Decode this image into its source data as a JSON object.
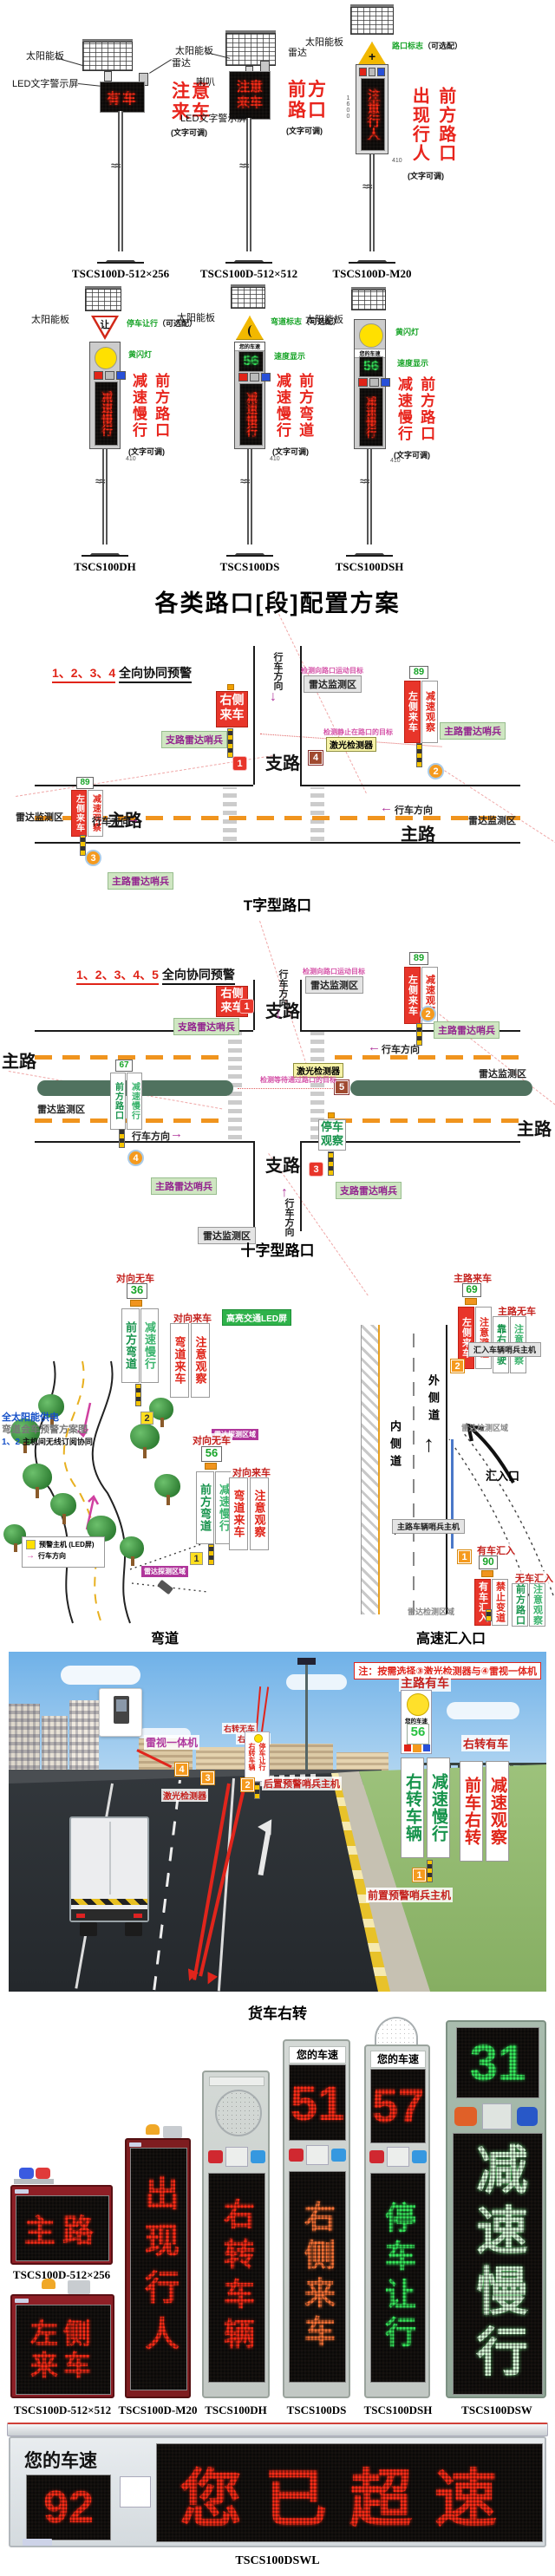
{
  "heading": "各类路口[段]配置方案",
  "colors": {
    "accent_red": "#e8241c",
    "led_red": "#ff2d18",
    "led_green": "#38e85c",
    "marker_orange": "#f59a1e",
    "median_green": "#50725f",
    "dash_orange": "#f0941e"
  },
  "row1": {
    "u1": {
      "model": "TSCS100D-512×256",
      "solar": "太阳能板",
      "radar": "雷达",
      "screen": "LED文字警示屏",
      "led": "有车",
      "ann": "注意来车",
      "note": "(文字可调)"
    },
    "u2": {
      "model": "TSCS100D-512×512",
      "solar": "太阳能板",
      "radar": "雷达",
      "horn": "喇叭",
      "screen": "LED文字警示屏",
      "led": "注意来车",
      "ann": "前方路口",
      "note": "(文字可调)"
    },
    "u3": {
      "model": "TSCS100D-M20",
      "solar": "太阳能板",
      "opt": "路口标志",
      "opt_note": "（可选配）",
      "led": "注意行人",
      "ann_left": "出现行人",
      "ann_right": "前方路口",
      "note": "(文字可调)",
      "dim_h": "1600",
      "dim_w": "410"
    }
  },
  "row2": {
    "u1": {
      "model": "TSCS100DH",
      "solar": "太阳能板",
      "opt": "停车让行",
      "opt_note": "（可选配）",
      "yield_char": "让",
      "light": "黄闪灯",
      "led": "减速慢行",
      "ann_left": "减速慢行",
      "ann_right": "前方路口",
      "note": "(文字可调)",
      "dim_w": "410"
    },
    "u2": {
      "model": "TSCS100DS",
      "solar": "太阳能板",
      "opt": "弯道标志",
      "opt_note": "（可选配）",
      "speed_title": "您的车速",
      "speed": "56",
      "speed_label": "速度显示",
      "led": "减速慢行",
      "ann_left": "减速慢行",
      "ann_right": "前方弯道",
      "note": "(文字可调)",
      "dim_w": "410"
    },
    "u3": {
      "model": "TSCS100DSH",
      "solar": "太阳能板",
      "light": "黄闪灯",
      "speed_title": "您的车速",
      "speed": "56",
      "speed_label": "速度显示",
      "led": "减速慢行",
      "ann_left": "减速慢行",
      "ann_right": "前方路口",
      "note": "(文字可调)",
      "dim_w": "410"
    }
  },
  "tj": {
    "nums": "1、2、3、4",
    "header": "全向协同预警",
    "caption": "T字型路口",
    "branch": "支路",
    "main_l": "主路",
    "main_r": "主路",
    "dir_down": "行车方向",
    "dir_right": "行车方向",
    "dir_left": "行车方向",
    "rz_cap": "检测向路口运动目标",
    "rz_top": "雷达监测区",
    "rz_right": "雷达监测区",
    "rz_left": "雷达监测区",
    "laser": "激光检测器",
    "laser_cap": "检测静止在路口的目标",
    "s1a": "右侧",
    "s1b": "来车",
    "bs": "支路雷达哨兵",
    "ms_r": "主路雷达哨兵",
    "ms_b": "主路雷达哨兵",
    "sp2": "89",
    "s2a": "左侧来车",
    "s2b": "减速观察",
    "sp3": "89",
    "s3a": "左侧来车",
    "s3b": "减速观察",
    "m1": "1",
    "m2": "2",
    "m3": "3",
    "m4": "4"
  },
  "cj": {
    "nums": "1、2、3、4、5",
    "header": "全向协同预警",
    "caption": "十字型路口",
    "branch_t": "支路",
    "branch_b": "支路",
    "main_l": "主路",
    "main_r": "主路",
    "dir_down": "行车方向",
    "dir_left": "行车方向",
    "dir_right": "行车方向",
    "dir_up": "行车方向",
    "rz_cap": "检测向路口运动目标",
    "rz_top": "雷达监测区",
    "rz_right": "雷达监测区",
    "rz_left": "雷达监测区",
    "rz_bottom": "雷达监测区",
    "laser": "激光检测器",
    "laser_cap": "检测等待通过路口的目标",
    "s1a": "右侧",
    "s1b": "来车",
    "bs_t": "支路雷达哨兵",
    "bs_b": "支路雷达哨兵",
    "ms_r": "主路雷达哨兵",
    "ms_l": "主路雷达哨兵",
    "sp2": "89",
    "s2a": "左侧来车",
    "s2b": "减速观察",
    "sp4": "67",
    "s4a": "前方路口",
    "s4b": "减速慢行",
    "s3a": "停车",
    "s3b": "观察",
    "m1": "1",
    "m2": "2",
    "m3": "3",
    "m4": "4",
    "m5": "5"
  },
  "curve": {
    "caption": "弯道",
    "power": "全太阳能供电",
    "plan": "弯道会车预警方案图",
    "sync_n": "1、2",
    "sync_t": "主机间无线订阅协同",
    "led_note": "高亮交通LED屏",
    "radar1": "雷达探测区域",
    "radar2": "雷达探测区域",
    "leg_host": "预警主机 (LED屏)",
    "leg_dir": "行车方向",
    "t_no": "对向无车",
    "t_sp": "36",
    "t_a": "前方弯道",
    "t_b": "减速慢行",
    "t_come": "对向来车",
    "t_c": "弯道来车",
    "t_d": "注意观察",
    "b_no": "对向无车",
    "b_sp": "56",
    "b_a": "前方弯道",
    "b_b": "减速慢行",
    "b_come": "对向来车",
    "b_c": "弯道来车",
    "b_d": "注意观察",
    "m1": "1",
    "m2": "2"
  },
  "merge": {
    "caption": "高速汇入口",
    "outer": "外侧道",
    "inner": "内侧道",
    "entry": "汇入口",
    "radar1": "雷达检测区域",
    "radar2": "雷达检测区域",
    "t_come": "主路来车",
    "t_sp": "69",
    "t_a": "左侧来车",
    "t_b": "注意避让",
    "t_no": "主路无车",
    "t_c": "靠右行驶",
    "t_d": "注意观察",
    "sentry_in": "汇入车辆哨兵主机",
    "sentry_main": "主路车辆哨兵主机",
    "b_come": "有车汇入",
    "b_sp": "90",
    "b_a": "有车汇入",
    "b_b": "禁止变道",
    "b_no": "无车汇入",
    "b_c": "前方路口",
    "b_d": "注意观察",
    "m1": "1",
    "m2": "2"
  },
  "truck": {
    "caption": "货车右转",
    "note": "注：按需选择③激光检测器与④雷视一体机",
    "radar_cam": "雷视一体机",
    "laser": "激光检测器",
    "rear_host": "后置预警哨兵主机",
    "front_host": "前置预警哨兵主机",
    "main_come": "主路有车",
    "speed_title": "您的车速",
    "speed": "56",
    "g1": "右转车辆",
    "g2": "减速慢行",
    "right_come": "右转有车",
    "r1": "前车右转",
    "r2": "减速观察",
    "s_no": "右转无车",
    "s_come": "右转有车",
    "s1": "右转车辆",
    "s2": "停车让行",
    "m1": "1",
    "m2": "2",
    "m3": "3",
    "m4": "4"
  },
  "products": {
    "p1": {
      "model": "TSCS100D-512×256",
      "led": "主路"
    },
    "p2": {
      "model": "TSCS100D-512×512",
      "led1": "左侧",
      "led2": "来车"
    },
    "p3": {
      "model": "TSCS100D-M20",
      "led": "出现行人"
    },
    "p4": {
      "model": "TSCS100DH",
      "led": "右转车辆"
    },
    "p5": {
      "model": "TSCS100DS",
      "speed_title": "您的车速",
      "speed": "51",
      "led": "右侧来车"
    },
    "p6": {
      "model": "TSCS100DSH",
      "speed_title": "您的车速",
      "speed": "57",
      "led": "停车让行"
    },
    "p7": {
      "model": "TSCS100DSW",
      "speed": "31",
      "led": "减速慢行"
    },
    "p8": {
      "model": "TSCS100DSWL",
      "speed_title": "您的车速",
      "speed": "92",
      "led": "您已超速"
    }
  }
}
